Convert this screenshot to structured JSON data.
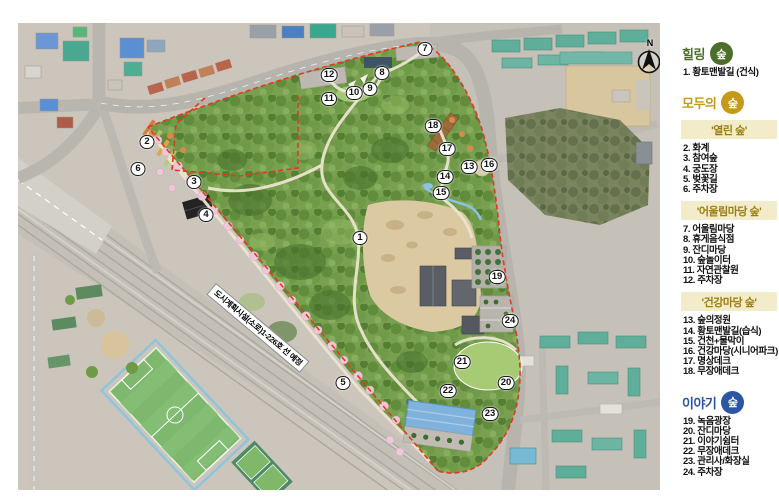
{
  "map": {
    "compass_label": "N",
    "road_label": "도시계획시설(소로)1-226호 선 예정",
    "boundary_color": "#e23a20",
    "markers": [
      {
        "n": "1",
        "x": 360,
        "y": 238
      },
      {
        "n": "2",
        "x": 147,
        "y": 142
      },
      {
        "n": "3",
        "x": 194,
        "y": 182
      },
      {
        "n": "4",
        "x": 206,
        "y": 215
      },
      {
        "n": "5",
        "x": 343,
        "y": 383
      },
      {
        "n": "6",
        "x": 138,
        "y": 169
      },
      {
        "n": "7",
        "x": 425,
        "y": 49
      },
      {
        "n": "8",
        "x": 382,
        "y": 73
      },
      {
        "n": "9",
        "x": 370,
        "y": 89
      },
      {
        "n": "10",
        "x": 354,
        "y": 93
      },
      {
        "n": "11",
        "x": 329,
        "y": 99
      },
      {
        "n": "12",
        "x": 329,
        "y": 75
      },
      {
        "n": "13",
        "x": 469,
        "y": 167
      },
      {
        "n": "14",
        "x": 445,
        "y": 177
      },
      {
        "n": "15",
        "x": 441,
        "y": 193
      },
      {
        "n": "16",
        "x": 489,
        "y": 165
      },
      {
        "n": "17",
        "x": 447,
        "y": 149
      },
      {
        "n": "18",
        "x": 433,
        "y": 126
      },
      {
        "n": "19",
        "x": 497,
        "y": 277
      },
      {
        "n": "20",
        "x": 506,
        "y": 383
      },
      {
        "n": "21",
        "x": 462,
        "y": 362
      },
      {
        "n": "22",
        "x": 448,
        "y": 391
      },
      {
        "n": "23",
        "x": 490,
        "y": 414
      },
      {
        "n": "24",
        "x": 510,
        "y": 321
      }
    ]
  },
  "legend": {
    "sections": [
      {
        "id": "healing",
        "title": "힐링",
        "badge": "숲",
        "color": "#4d6e2a",
        "subsections": [
          {
            "banner": null,
            "items": [
              "1. 황토맨발길 (건식)"
            ]
          }
        ]
      },
      {
        "id": "everyone",
        "title": "모두의",
        "badge": "숲",
        "color": "#c49a18",
        "subsections": [
          {
            "banner": "'열린 숲'",
            "items": [
              "2. 화계",
              "3. 참여숲",
              "4. 궁도장",
              "5. 벚꽃길",
              "6. 주차장"
            ]
          },
          {
            "banner": "'어울림마당 숲'",
            "items": [
              "7. 어울림마당",
              "8. 휴게음식점",
              "9. 잔디마당",
              "10. 숲놀이터",
              "11. 자연관찰원",
              "12. 주차장"
            ]
          },
          {
            "banner": "'건강마당 숲'",
            "items": [
              "13. 숲의정원",
              "14. 황토맨발길(습식)",
              "15. 건천+물막이",
              "16. 건강마당(시니어파크)",
              "17. 명상데크",
              "18. 무장애데크"
            ]
          }
        ]
      },
      {
        "id": "story",
        "title": "이야기",
        "badge": "숲",
        "color": "#2b55a5",
        "subsections": [
          {
            "banner": null,
            "items": [
              "19. 녹음광장",
              "20. 잔디마당",
              "21. 이야기쉼터",
              "22. 무장애데크",
              "23. 관리사/화장실",
              "24. 주차장"
            ]
          }
        ]
      }
    ]
  }
}
